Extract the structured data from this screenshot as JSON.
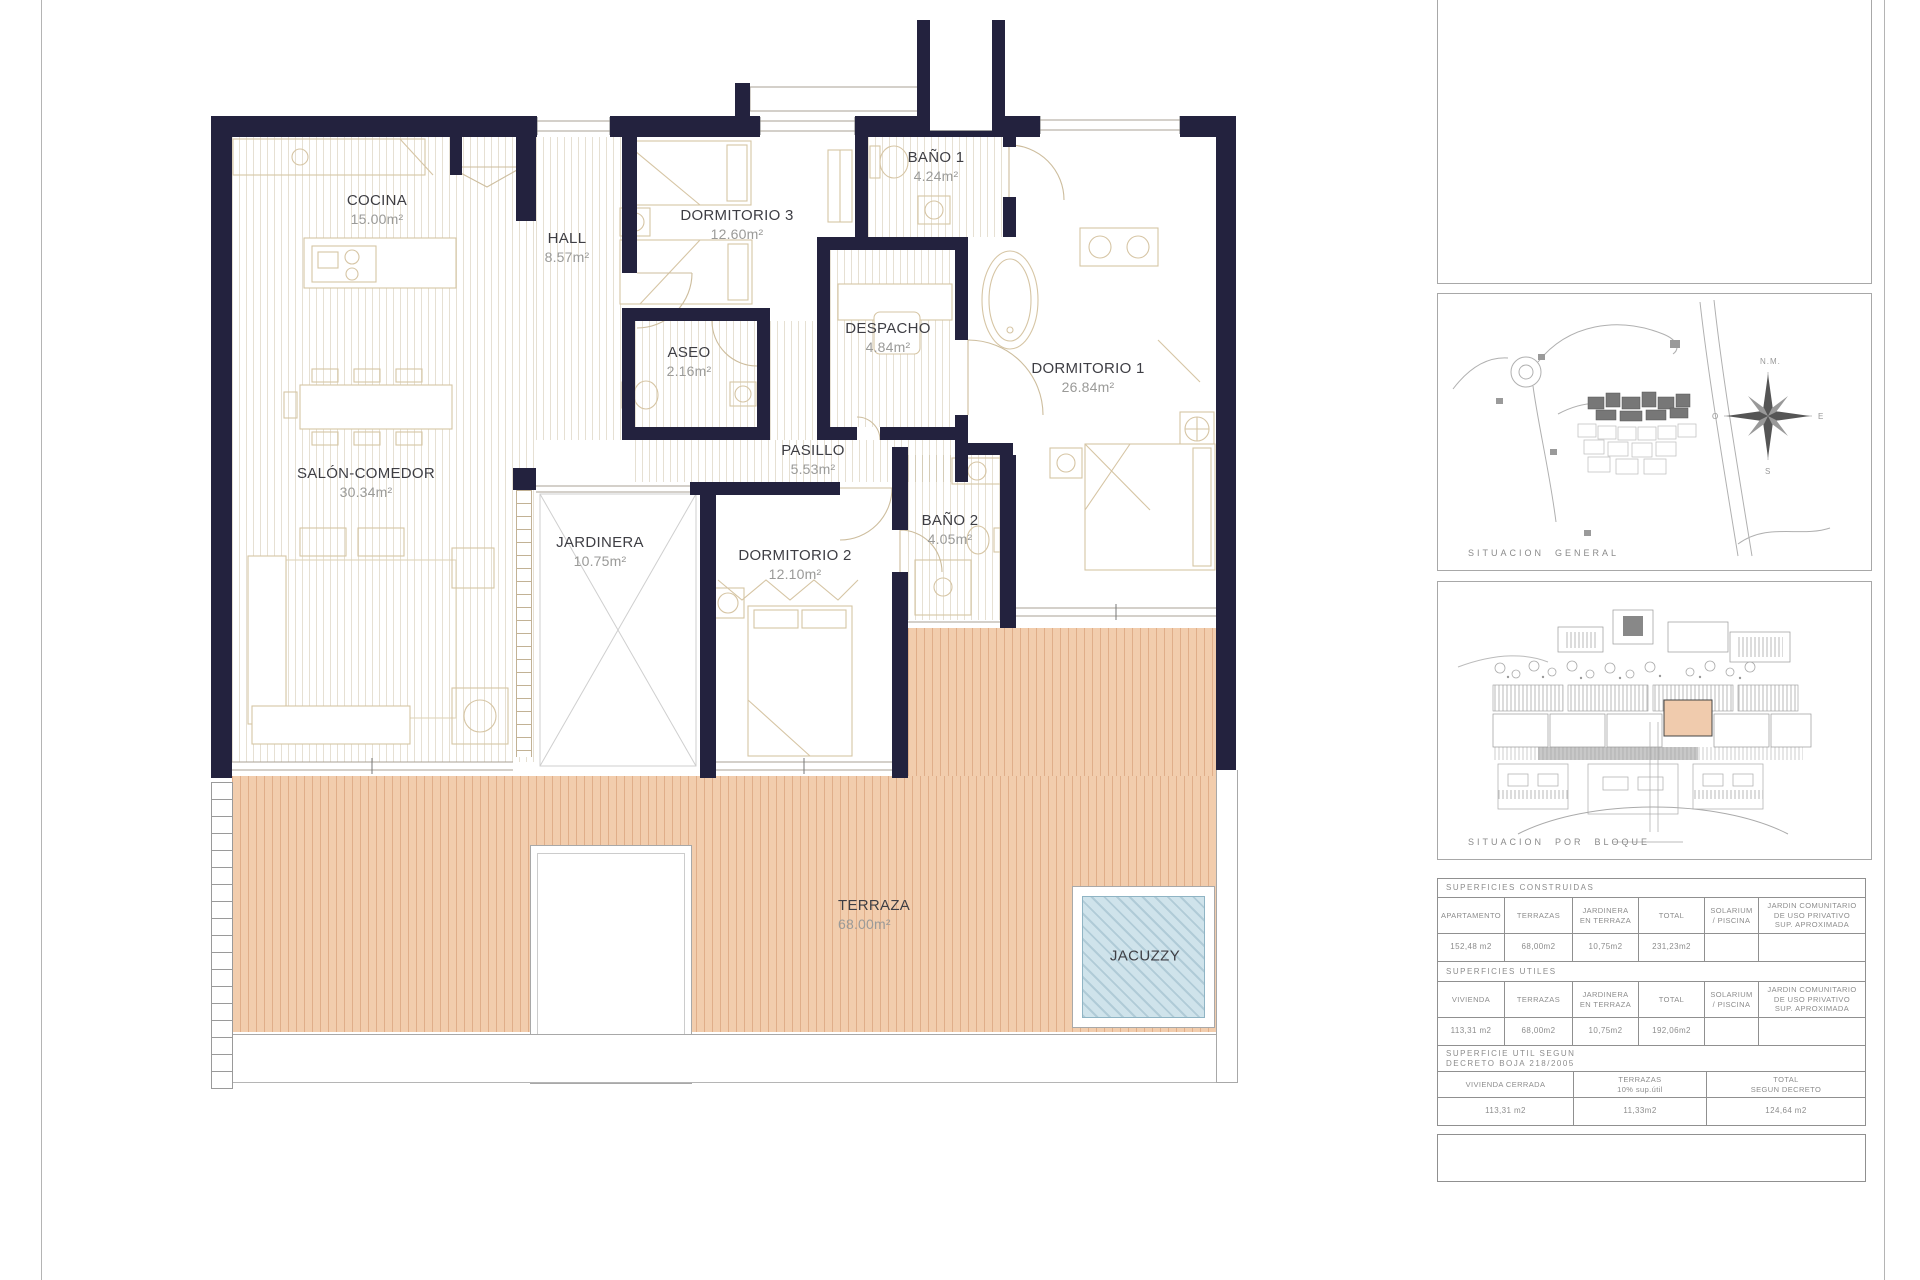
{
  "plan": {
    "rooms": [
      {
        "name": "COCINA",
        "area": "15.00m²"
      },
      {
        "name": "HALL",
        "area": "8.57m²"
      },
      {
        "name": "DORMITORIO 3",
        "area": "12.60m²"
      },
      {
        "name": "BAÑO 1",
        "area": "4.24m²"
      },
      {
        "name": "DESPACHO",
        "area": "4.84m²"
      },
      {
        "name": "ASEO",
        "area": "2.16m²"
      },
      {
        "name": "DORMITORIO 1",
        "area": "26.84m²"
      },
      {
        "name": "SALÓN-COMEDOR",
        "area": "30.34m²"
      },
      {
        "name": "PASILLO",
        "area": "5.53m²"
      },
      {
        "name": "JARDINERA",
        "area": "10.75m²"
      },
      {
        "name": "DORMITORIO 2",
        "area": "12.10m²"
      },
      {
        "name": "BAÑO 2",
        "area": "4.05m²"
      },
      {
        "name": "TERRAZA",
        "area": "68.00m²"
      }
    ],
    "jacuzzi_label": "JACUZZY",
    "wall_color": "#23223e",
    "terrace_color": "#f2cdad",
    "jacuzzi_color": "#cfe3eb"
  },
  "sidebar": {
    "situacion_general": "SITUACION  GENERAL",
    "situacion_por_bloque": "SITUACION  POR  BLOQUE",
    "compass": {
      "n": "N.M.",
      "e": "E",
      "s": "S",
      "o": "O"
    },
    "tables": {
      "construidas": {
        "title": "SUPERFICIES  CONSTRUIDAS",
        "headers": [
          "APARTAMENTO",
          "TERRAZAS",
          "JARDINERA\nEN TERRAZA",
          "TOTAL",
          "SOLARIUM\n/ PISCINA",
          "JARDIN COMUNITARIO\nDE USO PRIVATIVO\nSUP. APROXIMADA"
        ],
        "values": [
          "152,48 m2",
          "68,00m2",
          "10,75m2",
          "231,23m2",
          "",
          ""
        ]
      },
      "utiles": {
        "title": "SUPERFICIES  UTILES",
        "headers": [
          "VIVIENDA",
          "TERRAZAS",
          "JARDINERA\nEN TERRAZA",
          "TOTAL",
          "SOLARIUM\n/ PISCINA",
          "JARDIN COMUNITARIO\nDE USO PRIVATIVO\nSUP. APROXIMADA"
        ],
        "values": [
          "113,31 m2",
          "68,00m2",
          "10,75m2",
          "192,06m2",
          "",
          ""
        ]
      },
      "decreto": {
        "title": "SUPERFICIE UTIL SEGUN\nDECRETO BOJA 218/2005",
        "headers": [
          "VIVIENDA CERRADA",
          "TERRAZAS\n10% sup.útil",
          "TOTAL\nSEGUN DECRETO"
        ],
        "values": [
          "113,31 m2",
          "11,33m2",
          "124,64 m2"
        ]
      }
    }
  }
}
